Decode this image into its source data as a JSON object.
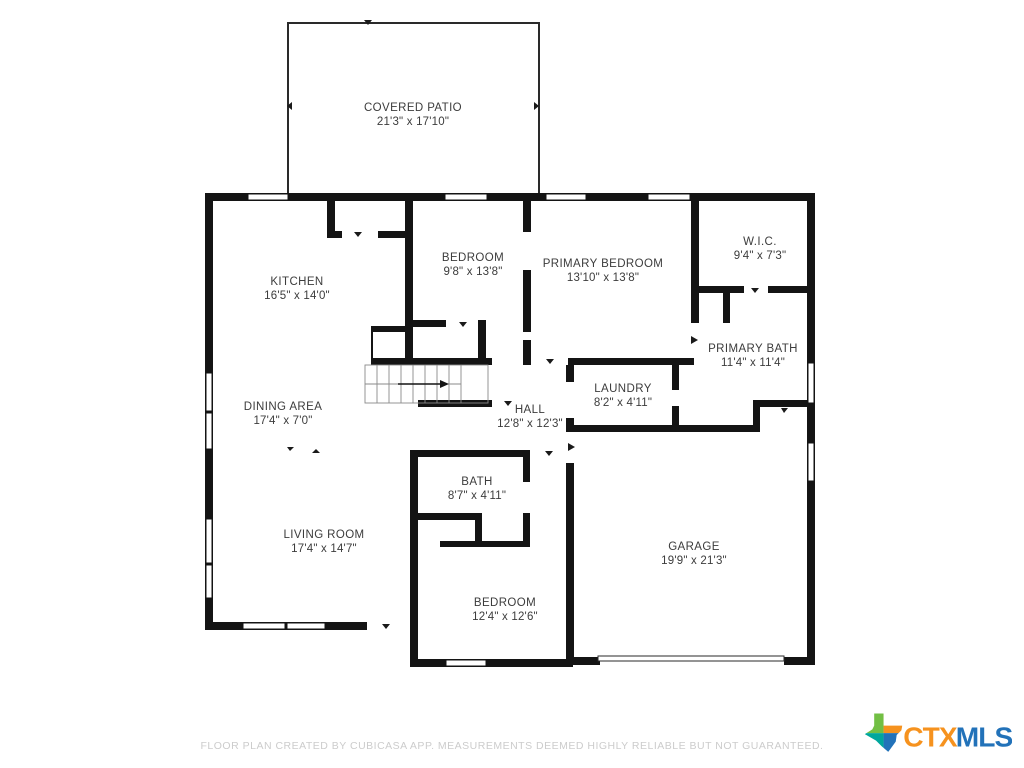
{
  "plan": {
    "rooms": {
      "covered_patio": {
        "name": "COVERED PATIO",
        "dims": "21'3\" x 17'10\""
      },
      "kitchen": {
        "name": "KITCHEN",
        "dims": "16'5\" x 14'0\""
      },
      "bedroom_top": {
        "name": "BEDROOM",
        "dims": "9'8\" x 13'8\""
      },
      "primary_bedroom": {
        "name": "PRIMARY BEDROOM",
        "dims": "13'10\" x 13'8\""
      },
      "wic": {
        "name": "W.I.C.",
        "dims": "9'4\" x 7'3\""
      },
      "primary_bath": {
        "name": "PRIMARY BATH",
        "dims": "11'4\" x 11'4\""
      },
      "laundry": {
        "name": "LAUNDRY",
        "dims": "8'2\" x 4'11\""
      },
      "hall": {
        "name": "HALL",
        "dims": "12'8\" x 12'3\""
      },
      "dining_area": {
        "name": "DINING AREA",
        "dims": "17'4\" x 7'0\""
      },
      "bath": {
        "name": "BATH",
        "dims": "8'7\" x 4'11\""
      },
      "living_room": {
        "name": "LIVING ROOM",
        "dims": "17'4\" x 14'7\""
      },
      "garage": {
        "name": "GARAGE",
        "dims": "19'9\" x 21'3\""
      },
      "bedroom_bottom": {
        "name": "BEDROOM",
        "dims": "12'4\" x 12'6\""
      }
    },
    "wall_color": "#141414"
  },
  "footer": {
    "disclaimer": "FLOOR PLAN CREATED BY CUBICASA APP. MEASUREMENTS DEEMED HIGHLY RELIABLE BUT NOT GUARANTEED."
  },
  "logo": {
    "ctx": "CTX",
    "mls": "MLS",
    "colors": {
      "ctx": "#F6921E",
      "mls": "#2272B9",
      "texas_top_left": "#72BF44",
      "texas_top_right": "#F6921E",
      "texas_bottom_left": "#00A79D",
      "texas_bottom_right": "#2272B9"
    }
  }
}
